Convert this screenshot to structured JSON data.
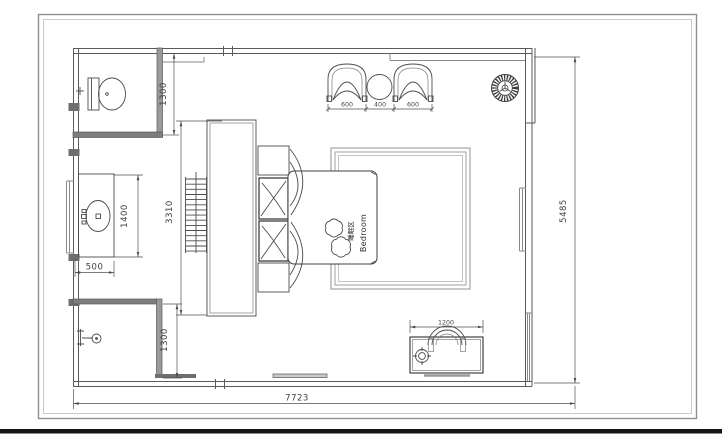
{
  "plan": {
    "labels": {
      "room_zone_cn": "睡眠区",
      "room_zone_en": "Bedroom"
    },
    "dimensions": {
      "overall_width": "7723",
      "overall_depth": "5485",
      "wc_depth": "1300",
      "closet_length": "3310",
      "vanity_length": "1400",
      "vanity_depth": "500",
      "shower_depth": "1300",
      "armchair_left": "600",
      "side_table": "400",
      "armchair_right": "600",
      "desk_length": "1200"
    },
    "colors": {
      "line": "#4b4b4b",
      "wall": "#8c8c8c",
      "frame": "#9b9b9b",
      "bottom_bar": "#151515",
      "background": "#ffffff"
    }
  }
}
